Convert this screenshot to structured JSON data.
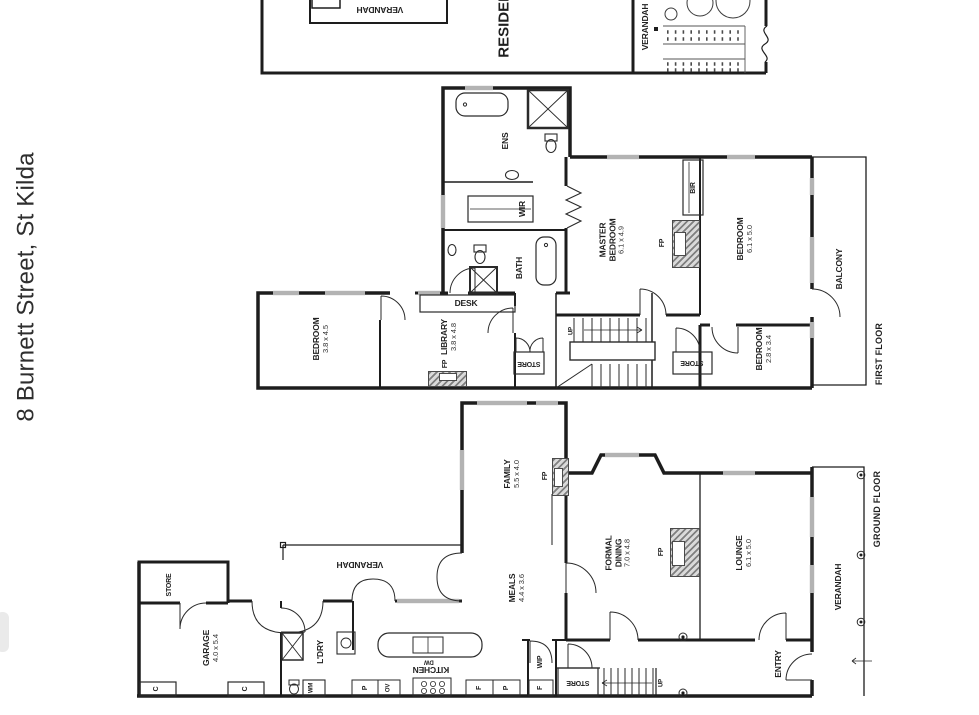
{
  "title": "8 Burnett Street, St Kilda",
  "colors": {
    "wall": "#1d1d1d",
    "window": "#b3b3b3",
    "text": "#1f1f1f"
  },
  "site_plan": {
    "verandah_box": "VERANDAH",
    "residence": "RESIDENCE",
    "verandah_side": "VERANDAH"
  },
  "first_floor": {
    "floor_label": "FIRST FLOOR",
    "ens": "ENS",
    "wir": "WIR",
    "bath": "BATH",
    "desk": "DESK",
    "master_bedroom": {
      "lines": [
        "MASTER",
        "BEDROOM",
        "6.1 x 4.9"
      ]
    },
    "fp_master": "FP",
    "bir": "BIR",
    "bedroom_right": {
      "lines": [
        "BEDROOM",
        "6.1 x 5.0"
      ]
    },
    "balcony": "BALCONY",
    "bedroom_small": {
      "lines": [
        "BEDROOM",
        "2.8 x 3.4"
      ]
    },
    "store_mid": "STORE",
    "store_right": "STORE",
    "bedroom_left": {
      "lines": [
        "BEDROOM",
        "3.8 x 4.5"
      ]
    },
    "library": {
      "lines": [
        "LIBRARY",
        "3.8 x 4.8"
      ]
    },
    "fp_library": "FP",
    "up": "UP"
  },
  "ground_floor": {
    "floor_label": "GROUND FLOOR",
    "store_garage": "STORE",
    "garage": {
      "lines": [
        "GARAGE",
        "4.0 x 5.4"
      ]
    },
    "cupboard_left": "C",
    "cupboard_right": "C",
    "verandah_top": "VERANDAH",
    "laundry": "L'DRY",
    "wm": "WM",
    "kitchen": "KITCHEN",
    "dw": "DW",
    "pantry_left": "P",
    "oven": "OV",
    "fridge_kitchen": "F",
    "pantry_right": "P",
    "meals": {
      "lines": [
        "MEALS",
        "4.4 x 3.6"
      ]
    },
    "family": {
      "lines": [
        "FAMILY",
        "5.5 x 4.0"
      ]
    },
    "fp_family": "FP",
    "formal_dining": {
      "lines": [
        "FORMAL",
        "DINING",
        "7.0 x 4.8"
      ]
    },
    "fp_dining": "FP",
    "lounge": {
      "lines": [
        "LOUNGE",
        "6.1 x 5.0"
      ]
    },
    "entry": "ENTRY",
    "wip": "WIP",
    "fridge_wip": "F",
    "store_hall": "STORE",
    "up": "UP",
    "verandah_right": "VERANDAH"
  }
}
